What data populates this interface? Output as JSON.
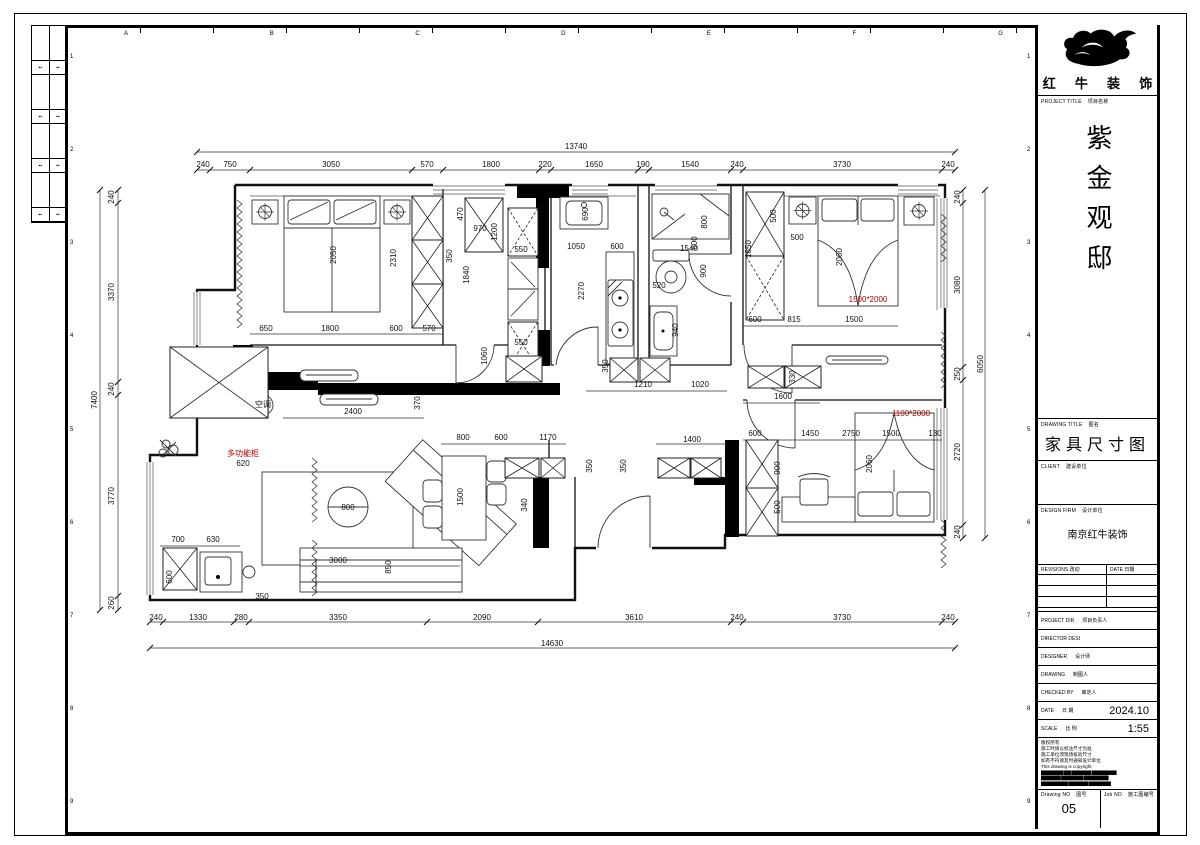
{
  "colors": {
    "annotation_red": "#b00000",
    "line_black": "#111111"
  },
  "frame": {
    "top_letters": [
      "A",
      "B",
      "C",
      "D",
      "E",
      "F",
      "G",
      "H"
    ],
    "side_numbers": [
      "1",
      "2",
      "3",
      "4",
      "5",
      "6",
      "7",
      "8",
      "9"
    ]
  },
  "side_strip": {
    "marks": [
      [
        "▪▪",
        "▪▪"
      ],
      [
        "▪▪",
        "▪▪"
      ],
      [
        "▪▪",
        "▪▪"
      ],
      [
        "▪▪",
        "▪▪"
      ]
    ]
  },
  "title_block": {
    "logo_text": [
      "红",
      "牛",
      "装",
      "饰"
    ],
    "project_label_en": "PROJECT TITLE",
    "project_label_cn": "项目名称",
    "project_name": "紫金观邸",
    "drawing_title_label_en": "DRAWING TITLE",
    "drawing_title_label_cn": "图名",
    "drawing_title": "家具尺寸图",
    "client_label_en": "CLIENT",
    "client_label_cn": "建设单位",
    "firm_label_en": "DESIGN FIRM",
    "firm_label_cn": "设计单位",
    "firm_name": "南京红牛装饰",
    "revisions_label_en": "REVISIONS",
    "revisions_label_cn": "改动",
    "rev_date_label_en": "DATE",
    "rev_date_label_cn": "日期",
    "rows": [
      {
        "en": "PROJECT DIR",
        "cn": "项目负责人",
        "value": ""
      },
      {
        "en": "DIRECTOR DESI",
        "cn": "",
        "value": ""
      },
      {
        "en": "DESIGNER",
        "cn": "设计师",
        "value": ""
      },
      {
        "en": "DRAWING",
        "cn": "制图人",
        "value": ""
      },
      {
        "en": "CHECKED BY",
        "cn": "审定人",
        "value": ""
      },
      {
        "en": "DATE",
        "cn": "日 期",
        "value": "2024.10"
      },
      {
        "en": "SCALE",
        "cn": "比 例",
        "value": "1:55"
      }
    ],
    "notes": [
      "版权所有",
      "施工时请以标注尺寸为准",
      "施工单位须现场核验尺寸",
      "如有不符请及时通知设计单位",
      "This drawing is copyright",
      "█████████ ███ ████████ ██████████",
      "████████ █████████ ██████████",
      "███████████ ████████ █████████"
    ],
    "drawing_no_label_en": "Drawing NO",
    "drawing_no_label_cn": "图号",
    "drawing_no": "05",
    "job_no_label_en": "Job NO",
    "job_no_label_cn": "施工图编号",
    "job_no": ""
  },
  "plan": {
    "annotations": [
      [
        "13740",
        576,
        149
      ],
      [
        "240",
        203,
        167
      ],
      [
        "750",
        230,
        167
      ],
      [
        "3050",
        331,
        167
      ],
      [
        "570",
        427,
        167
      ],
      [
        "1800",
        491,
        167
      ],
      [
        "220",
        545,
        167
      ],
      [
        "1650",
        594,
        167
      ],
      [
        "190",
        643,
        167
      ],
      [
        "1540",
        690,
        167
      ],
      [
        "240",
        737,
        167
      ],
      [
        "3730",
        842,
        167
      ],
      [
        "240",
        948,
        167
      ],
      [
        "240",
        156,
        620
      ],
      [
        "1330",
        198,
        620
      ],
      [
        "280",
        241,
        620
      ],
      [
        "3350",
        338,
        620
      ],
      [
        "2090",
        482,
        620
      ],
      [
        "3610",
        634,
        620
      ],
      [
        "240",
        737,
        620
      ],
      [
        "3730",
        842,
        620
      ],
      [
        "240",
        948,
        620
      ],
      [
        "14630",
        552,
        646
      ],
      [
        "7400",
        97,
        400,
        -90
      ],
      [
        "240",
        114,
        197,
        -90
      ],
      [
        "3370",
        114,
        292,
        -90
      ],
      [
        "240",
        114,
        389,
        -90
      ],
      [
        "3770",
        114,
        496,
        -90
      ],
      [
        "260",
        114,
        603,
        -90
      ],
      [
        "6050",
        983,
        364,
        -90
      ],
      [
        "240",
        960,
        197,
        -90
      ],
      [
        "3080",
        960,
        285,
        -90
      ],
      [
        "250",
        960,
        374,
        -90
      ],
      [
        "2720",
        960,
        452,
        -90
      ],
      [
        "240",
        960,
        532,
        -90
      ],
      [
        "2050",
        336,
        255,
        -90
      ],
      [
        "2310",
        396,
        258,
        -90
      ],
      [
        "650",
        266,
        331
      ],
      [
        "1800",
        330,
        331
      ],
      [
        "600",
        396,
        331
      ],
      [
        "570",
        429,
        331
      ],
      [
        "470",
        463,
        214,
        -90
      ],
      [
        "970",
        480,
        231
      ],
      [
        "1200",
        497,
        232,
        -90
      ],
      [
        "350",
        452,
        256,
        -90
      ],
      [
        "1840",
        469,
        275,
        -90
      ],
      [
        "550",
        521,
        252
      ],
      [
        "550",
        521,
        345
      ],
      [
        "1060",
        487,
        356,
        -90
      ],
      [
        "2400",
        353,
        414
      ],
      [
        "370",
        420,
        403,
        -90
      ],
      [
        "620",
        243,
        466
      ],
      [
        "多功能柜",
        243,
        456,
        0,
        "red",
        5
      ],
      [
        "690",
        588,
        214,
        -90
      ],
      [
        "1050",
        576,
        249
      ],
      [
        "600",
        617,
        249
      ],
      [
        "2270",
        584,
        291,
        -90
      ],
      [
        "350",
        608,
        366,
        -90
      ],
      [
        "800",
        707,
        222,
        -90
      ],
      [
        "600",
        697,
        243,
        -90
      ],
      [
        "1540",
        689,
        251
      ],
      [
        "900",
        706,
        271,
        -90
      ],
      [
        "520",
        659,
        288
      ],
      [
        "940",
        678,
        330,
        -90
      ],
      [
        "1210",
        643,
        387
      ],
      [
        "1020",
        700,
        387
      ],
      [
        "1600",
        783,
        399
      ],
      [
        "330",
        795,
        377,
        -90
      ],
      [
        "1850",
        751,
        249,
        -90
      ],
      [
        "500",
        776,
        216,
        -90
      ],
      [
        "500",
        797,
        240
      ],
      [
        "2060",
        842,
        257,
        -90
      ],
      [
        "600",
        755,
        322
      ],
      [
        "815",
        794,
        322
      ],
      [
        "1500",
        854,
        322
      ],
      [
        "1500*2000",
        868,
        302,
        0,
        "red",
        5
      ],
      [
        "600",
        755,
        436
      ],
      [
        "1450",
        810,
        436
      ],
      [
        "2750",
        851,
        436
      ],
      [
        "1500",
        891,
        436
      ],
      [
        "130",
        935,
        436
      ],
      [
        "900",
        780,
        468,
        -90
      ],
      [
        "500",
        780,
        507,
        -90
      ],
      [
        "2060",
        872,
        464,
        -90
      ],
      [
        "1100*2000",
        911,
        416,
        0,
        "red",
        5
      ],
      [
        "800",
        348,
        510
      ],
      [
        "3000",
        338,
        563
      ],
      [
        "850",
        391,
        567,
        -90
      ],
      [
        "700",
        178,
        542
      ],
      [
        "630",
        213,
        542
      ],
      [
        "600",
        172,
        577,
        -90
      ],
      [
        "350",
        262,
        599
      ],
      [
        "800",
        463,
        440
      ],
      [
        "600",
        501,
        440
      ],
      [
        "1170",
        548,
        440
      ],
      [
        "1500",
        463,
        497,
        -90
      ],
      [
        "340",
        527,
        505,
        -90
      ],
      [
        "350",
        592,
        466,
        -90
      ],
      [
        "350",
        626,
        466,
        -90
      ],
      [
        "1400",
        692,
        442
      ],
      [
        "空调",
        263,
        407,
        0,
        null,
        5
      ]
    ]
  }
}
